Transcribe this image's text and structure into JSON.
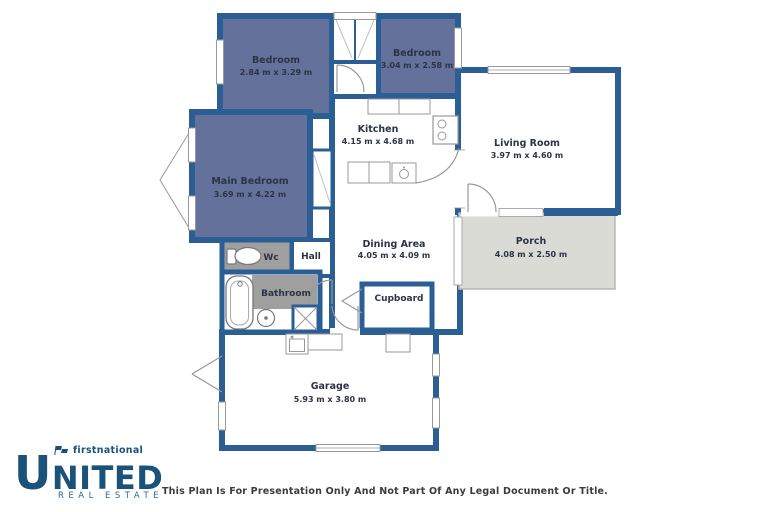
{
  "window": {
    "width": 768,
    "height": 512,
    "background": "#ffffff"
  },
  "palette": {
    "wall": "#2b5e95",
    "bedroom_fill": "#64719a",
    "wet_area_fill": "#9f9f9f",
    "porch_fill": "#dbdbd5",
    "room_fill": "#ffffff",
    "label_color": "#2b3346",
    "fixture_line": "#8f8f8f",
    "logo_navy": "#1a527a",
    "disclaimer_color": "#3b3b3b"
  },
  "rooms": [
    {
      "name": "Bedroom",
      "dims": "2.84 m x 3.29 m"
    },
    {
      "name": "Bedroom",
      "dims": "3.04 m x 2.58 m"
    },
    {
      "name": "Main Bedroom",
      "dims": "3.69 m x 4.22 m"
    },
    {
      "name": "Kitchen",
      "dims": "4.15 m x 4.68 m"
    },
    {
      "name": "Living Room",
      "dims": "3.97 m x 4.60 m"
    },
    {
      "name": "Porch",
      "dims": "4.08 m x 2.50 m"
    },
    {
      "name": "Dining Area",
      "dims": "4.05 m x 4.09 m"
    },
    {
      "name": "Wc"
    },
    {
      "name": "Hall"
    },
    {
      "name": "Bathroom"
    },
    {
      "name": "Cupboard"
    },
    {
      "name": "Garage",
      "dims": "5.93 m x 3.80 m"
    }
  ],
  "branding": {
    "prefix": "firstnational",
    "name": "UNITED",
    "tagline": "REAL ESTATE"
  },
  "footer": {
    "disclaimer": "This Plan Is For Presentation Only And Not Part Of Any Legal Document Or Title."
  }
}
